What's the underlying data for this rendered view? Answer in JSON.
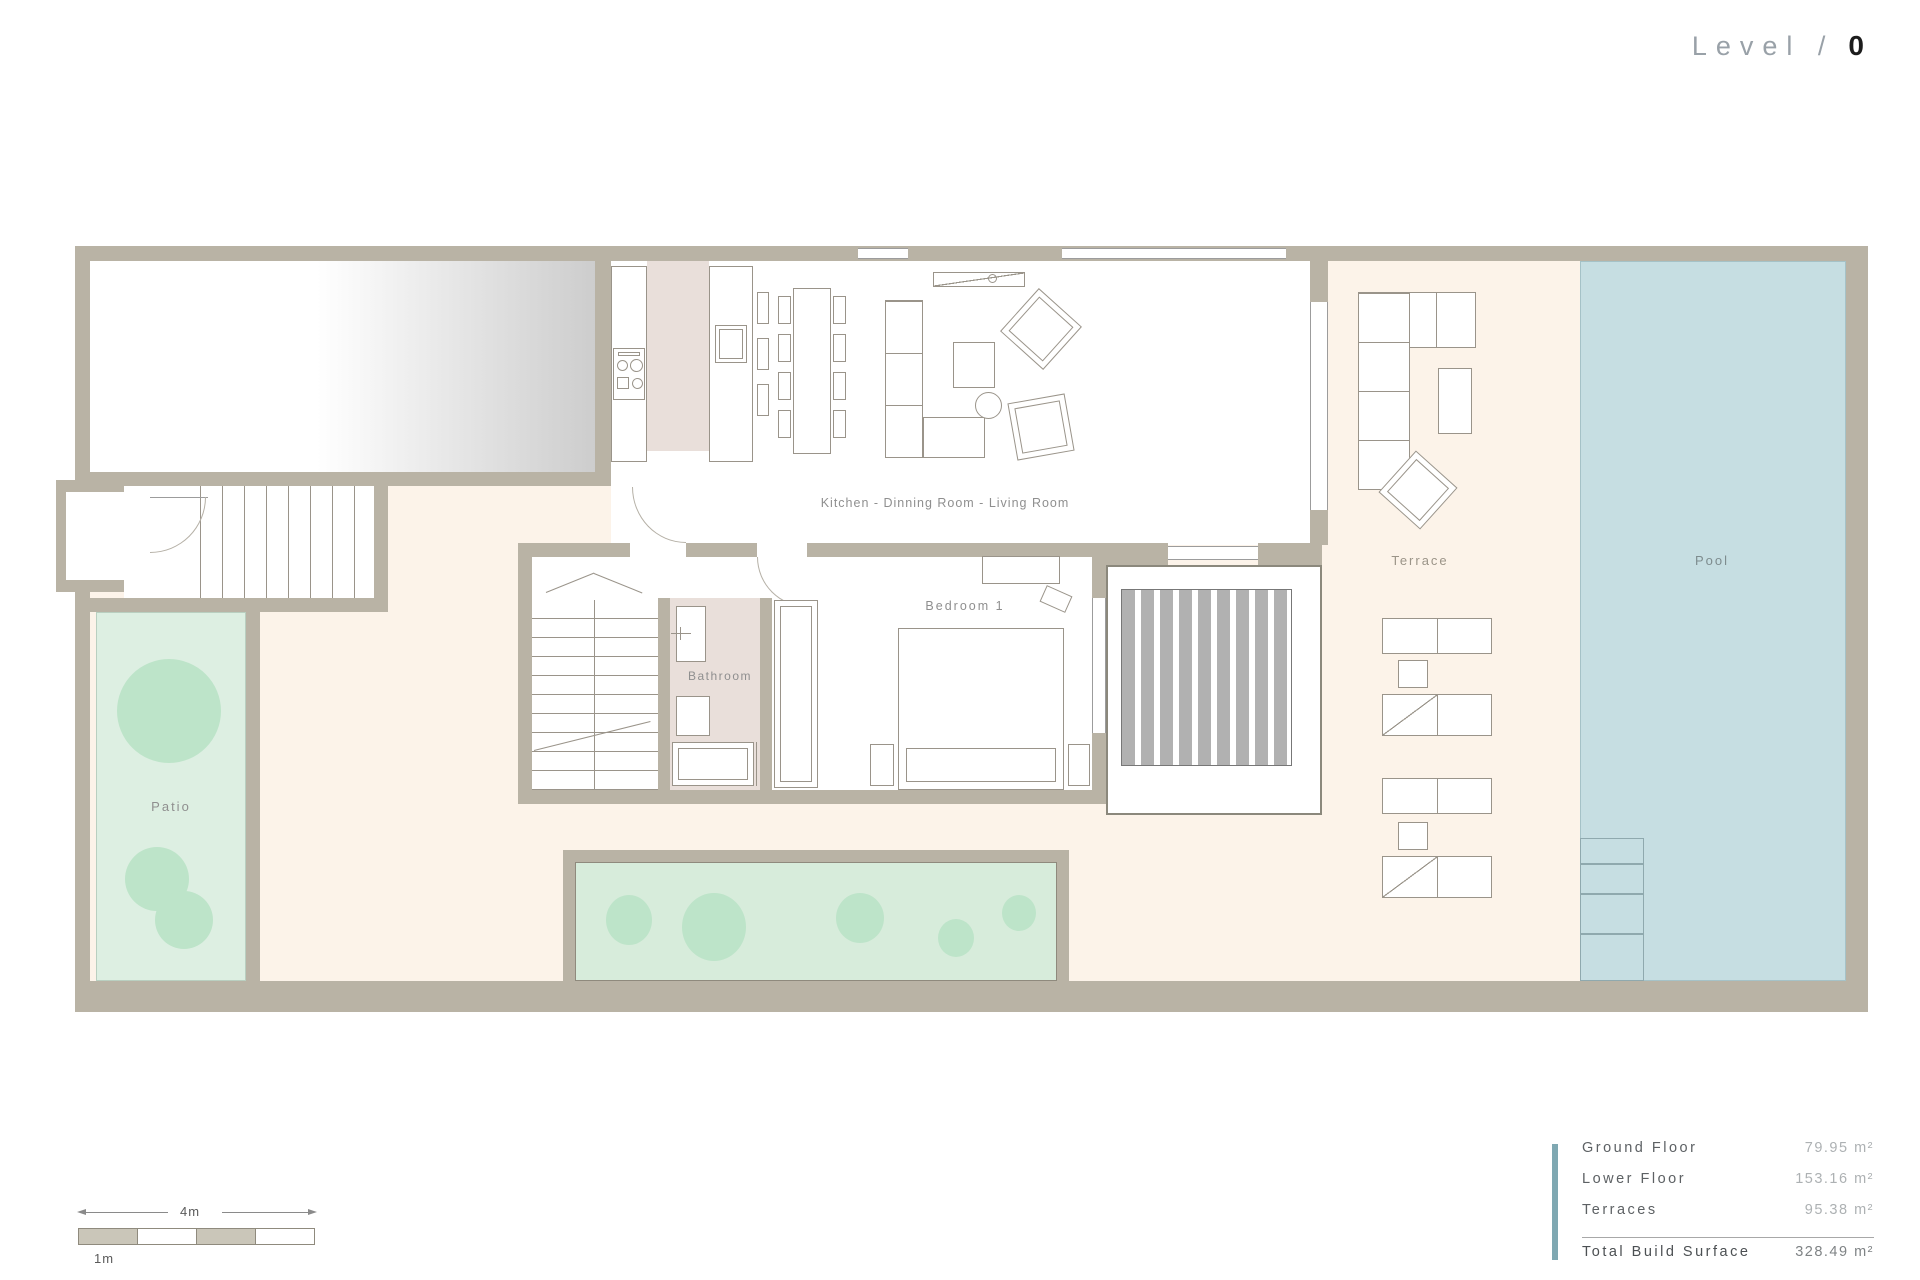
{
  "title": {
    "prefix": "Level /",
    "level": "0"
  },
  "rooms": {
    "kitchen_living": "Kitchen - Dinning Room - Living Room",
    "bedroom": "Bedroom 1",
    "bathroom": "Bathroom",
    "patio": "Patio",
    "terrace": "Terrace",
    "pool": "Pool"
  },
  "legend": {
    "rows": [
      {
        "label": "Ground Floor",
        "value": "79.95 m²"
      },
      {
        "label": "Lower Floor",
        "value": "153.16 m²"
      },
      {
        "label": "Terraces",
        "value": "95.38 m²"
      }
    ],
    "total": {
      "label": "Total Build Surface",
      "value": "328.49 m²"
    }
  },
  "scale_bar": {
    "total_label": "4m",
    "unit_label": "1m"
  },
  "colors": {
    "wall": "#b9b3a5",
    "terrace-cream": "#fcf3e9",
    "pool-blue": "#c6dee2",
    "pool-edge": "#a5c2c7",
    "patio-green": "#ddefe2",
    "bush-green": "#bde4c9",
    "planter-green": "#d7ecdb",
    "kitchen-pink": "#e9dfda",
    "deck-stripe-gray": "#b1b1b1",
    "accent-teal": "#7fa8b2",
    "line-gray": "#9a948a",
    "label-gray": "#8f8f8f"
  }
}
